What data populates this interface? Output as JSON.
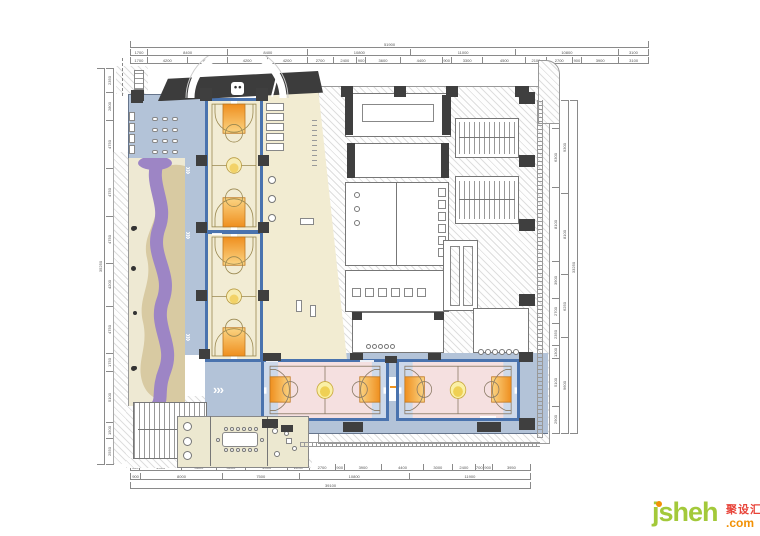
{
  "palette": {
    "court_border_blue": "#4a73ae",
    "key_orange": "#f0941f",
    "corridor_blue": "#b3c3d8",
    "court_pink": "#f5e0e0",
    "play_purple": "#9d85c5",
    "sand_tan": "#d8caa2",
    "court_cream": "#f2ecd4",
    "entrance_dark": "#3c3c3c",
    "logo_green": "#a3c93a",
    "logo_orange": "#f29105",
    "logo_red": "#e8443a"
  },
  "watermark": {
    "name": "jsheh",
    "tld": ".com",
    "cn": "聚设汇"
  },
  "icons": {
    "chevrons": "›››"
  },
  "dimensions": {
    "top": {
      "overall": [
        {
          "t": "51900",
          "w": 519
        }
      ],
      "mid": [
        {
          "t": "1700",
          "w": 17
        },
        {
          "t": "8400",
          "w": 84
        },
        {
          "t": "8400",
          "w": 84
        },
        {
          "t": "10800",
          "w": 108
        },
        {
          "t": "11000",
          "w": 110
        },
        {
          "t": "10800",
          "w": 108
        },
        {
          "t": "3100",
          "w": 31
        }
      ],
      "inner": [
        {
          "t": "1700",
          "w": 17
        },
        {
          "t": "4200",
          "w": 42
        },
        {
          "t": "4200",
          "w": 42
        },
        {
          "t": "4200",
          "w": 42
        },
        {
          "t": "4200",
          "w": 42
        },
        {
          "t": "2700",
          "w": 27
        },
        {
          "t": "2400",
          "w": 24
        },
        {
          "t": "900",
          "w": 9
        },
        {
          "t": "3600",
          "w": 36
        },
        {
          "t": "4400",
          "w": 44
        },
        {
          "t": "900",
          "w": 9
        },
        {
          "t": "3300",
          "w": 33
        },
        {
          "t": "4500",
          "w": 45
        },
        {
          "t": "2100",
          "w": 21
        },
        {
          "t": "2700",
          "w": 27
        },
        {
          "t": "900",
          "w": 9
        },
        {
          "t": "3900",
          "w": 39
        },
        {
          "t": "3100",
          "w": 31
        }
      ]
    },
    "bottom": {
      "inner": [
        {
          "t": "900",
          "w": 9
        },
        {
          "t": "4400",
          "w": 44
        },
        {
          "t": "3600",
          "w": 36
        },
        {
          "t": "3100",
          "w": 31
        },
        {
          "t": "4400",
          "w": 44
        },
        {
          "t": "2200",
          "w": 22
        },
        {
          "t": "2700",
          "w": 27
        },
        {
          "t": "900",
          "w": 9
        },
        {
          "t": "3900",
          "w": 39
        },
        {
          "t": "4400",
          "w": 44
        },
        {
          "t": "3000",
          "w": 30
        },
        {
          "t": "2400",
          "w": 24
        },
        {
          "t": "700",
          "w": 7
        },
        {
          "t": "900",
          "w": 9
        },
        {
          "t": "3950",
          "w": 40
        }
      ],
      "mid": [
        {
          "t": "900",
          "w": 9
        },
        {
          "t": "8000",
          "w": 80
        },
        {
          "t": "7500",
          "w": 75
        },
        {
          "t": "10800",
          "w": 108
        },
        {
          "t": "11900",
          "w": 119
        }
      ],
      "overall": [
        {
          "t": "39100",
          "w": 391
        }
      ]
    },
    "left": {
      "inner": [
        {
          "t": "2350",
          "w": 23
        },
        {
          "t": "2800",
          "w": 28
        },
        {
          "t": "4750",
          "w": 47
        },
        {
          "t": "4750",
          "w": 47
        },
        {
          "t": "4750",
          "w": 47
        },
        {
          "t": "4200",
          "w": 42
        },
        {
          "t": "4750",
          "w": 47
        },
        {
          "t": "1750",
          "w": 17
        },
        {
          "t": "5100",
          "w": 51
        },
        {
          "t": "1500",
          "w": 15
        },
        {
          "t": "2550",
          "w": 25
        }
      ],
      "overall": [
        {
          "t": "35250",
          "w": 352
        }
      ]
    },
    "right": {
      "inner": [
        {
          "t": "3000",
          "w": 30
        },
        {
          "t": "6300",
          "w": 63
        },
        {
          "t": "8100",
          "w": 81
        },
        {
          "t": "3900",
          "w": 39
        },
        {
          "t": "2700",
          "w": 27
        },
        {
          "t": "2350",
          "w": 23
        },
        {
          "t": "1300",
          "w": 13
        },
        {
          "t": "5100",
          "w": 51
        },
        {
          "t": "2900",
          "w": 29
        }
      ],
      "mid": [
        {
          "t": "9300",
          "w": 93
        },
        {
          "t": "8100",
          "w": 81
        },
        {
          "t": "6250",
          "w": 62
        },
        {
          "t": "9600",
          "w": 96
        }
      ],
      "overall": [
        {
          "t": "33250",
          "w": 332
        }
      ]
    }
  }
}
